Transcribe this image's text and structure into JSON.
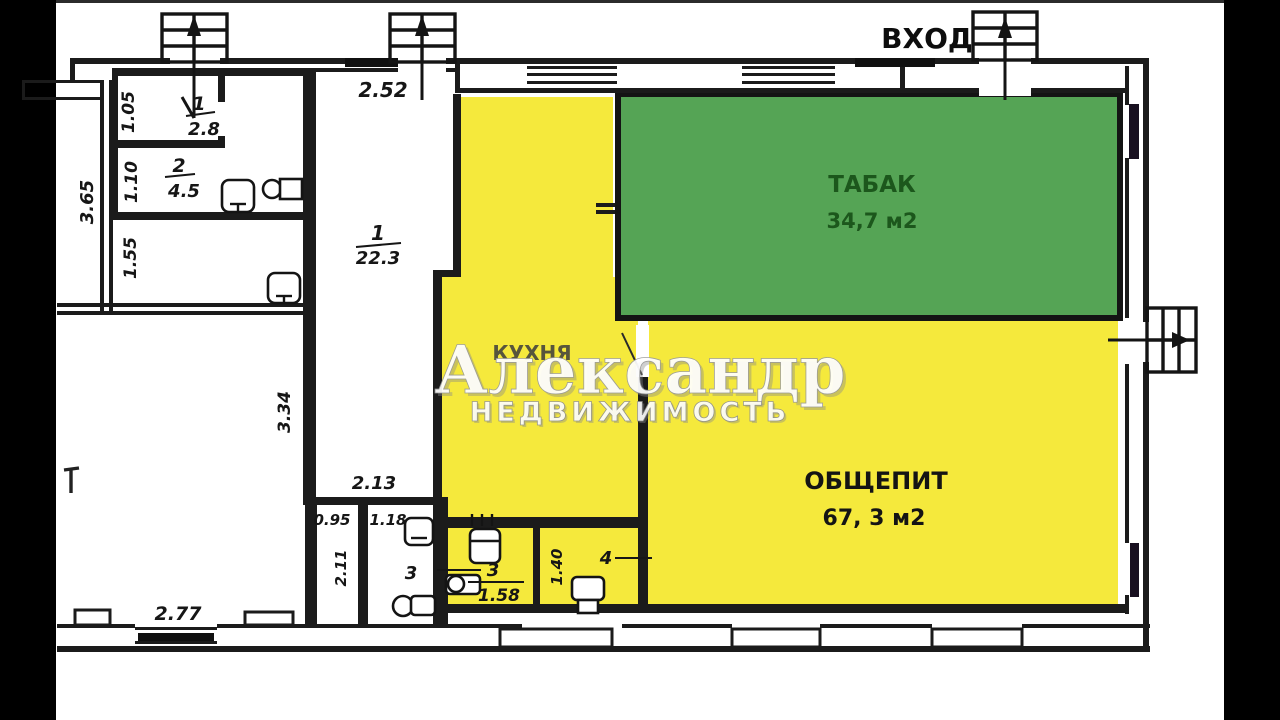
{
  "colors": {
    "room_yellow": "#f5e93c",
    "tabak_green": "#55a455",
    "tabak_text": "#1c571c",
    "wall": "#1b1b1b"
  },
  "watermark": {
    "line1": "Александр",
    "line2": "НЕДВИЖИМОСТЬ"
  },
  "entrance": {
    "label": "ВХОД"
  },
  "rooms": {
    "tabak": {
      "name": "ТАБАК",
      "area": "34,7 м2"
    },
    "obshchepit": {
      "name": "ОБЩЕПИТ",
      "area": "67, 3 м2"
    },
    "kitchen": {
      "name": "КУХНЯ"
    },
    "hall": {
      "number": "1",
      "area": "22.3"
    },
    "storeroom": {
      "number": "1",
      "area": "2.8"
    },
    "room2": {
      "number": "2",
      "area": "4.5"
    },
    "wc3": {
      "number": "3"
    },
    "bath3": {
      "number": "3",
      "area": "1.58"
    },
    "wc4": {
      "number": "4"
    }
  },
  "dimensions": {
    "d105": "1.05",
    "d110": "1.10",
    "d365": "3.65",
    "d155": "1.55",
    "d252": "2.52",
    "d334": "3.34",
    "d213": "2.13",
    "d095": "0.95",
    "d118": "1.18",
    "d211": "2.11",
    "d277": "2.77",
    "d140": "1.40"
  }
}
